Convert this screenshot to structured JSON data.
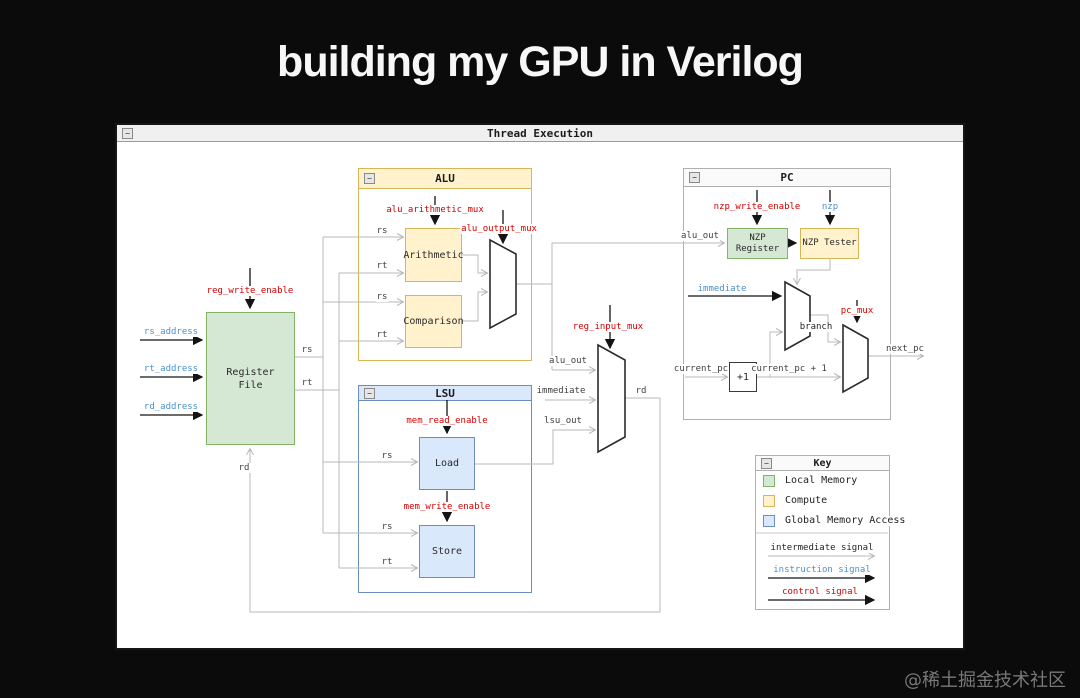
{
  "page": {
    "title": "building my GPU in Verilog",
    "watermark": "@稀土掘金技术社区"
  },
  "window": {
    "title": "Thread Execution"
  },
  "icons": {
    "collapse": "−"
  },
  "blocks": {
    "alu": "ALU",
    "lsu": "LSU",
    "pc": "PC",
    "register_file_line1": "Register",
    "register_file_line2": "File",
    "arithmetic": "Arithmetic",
    "comparison": "Comparison",
    "load": "Load",
    "store": "Store",
    "nzp_register_line1": "NZP",
    "nzp_register_line2": "Register",
    "nzp_tester": "NZP Tester",
    "plus_one": "+1"
  },
  "labels": {
    "rs": "rs",
    "rt": "rt",
    "rd": "rd",
    "alu_out": "alu_out",
    "immediate": "immediate",
    "lsu_out": "lsu_out",
    "branch": "branch",
    "current_pc": "current_pc",
    "current_pc_plus_1": "current_pc + 1",
    "next_pc": "next_pc",
    "rs_address": "rs_address",
    "rt_address": "rt_address",
    "rd_address": "rd_address",
    "reg_write_enable": "reg_write_enable",
    "alu_arithmetic_mux": "alu_arithmetic_mux",
    "alu_output_mux": "alu_output_mux",
    "reg_input_mux": "reg_input_mux",
    "mem_read_enable": "mem_read_enable",
    "mem_write_enable": "mem_write_enable",
    "nzp_write_enable": "nzp_write_enable",
    "nzp": "nzp",
    "pc_mux": "pc_mux"
  },
  "key": {
    "title": "Key",
    "local_memory": "Local Memory",
    "compute": "Compute",
    "global_memory": "Global Memory Access",
    "intermediate_signal": "intermediate signal",
    "instruction_signal": "instruction signal",
    "control_signal": "control signal"
  },
  "colors": {
    "local_memory_fill": "#d5e8d4",
    "local_memory_stroke": "#82b366",
    "compute_fill": "#fff2cc",
    "compute_stroke": "#d6b656",
    "global_memory_fill": "#dae8fc",
    "global_memory_stroke": "#6c8ebf",
    "control_signal_text": "#d40000",
    "instruction_signal_text": "#4d8fcc",
    "intermediate_wire": "#b8b8b8"
  }
}
